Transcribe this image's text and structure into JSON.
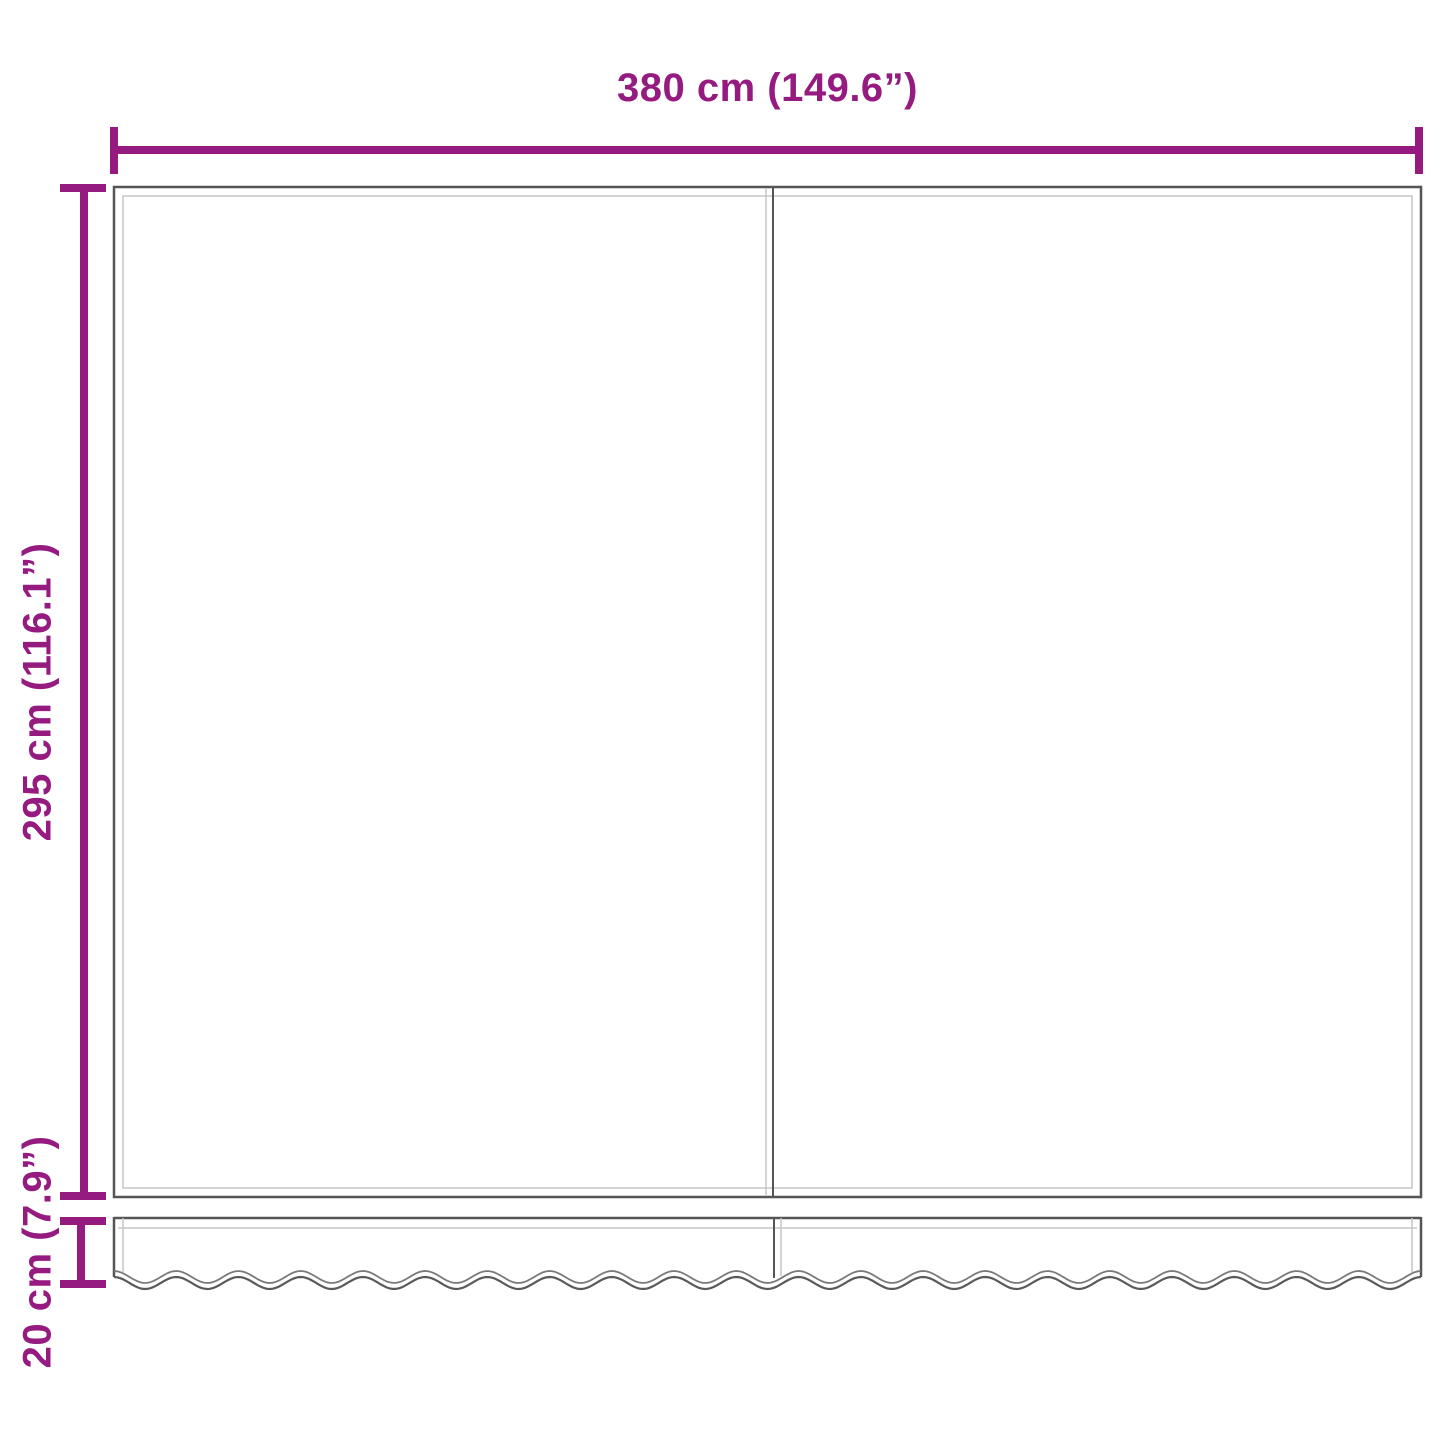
{
  "diagram": {
    "type": "awning-replacement-fabric-dimension-drawing",
    "width_dimension_label": "380 cm (149.6”)",
    "height_dimension_label": "295 cm (116.1”)",
    "valance_height_dimension_label": "20 cm (7.9”)"
  },
  "colors": {
    "accent": "#951b81",
    "line_dark": "#555555",
    "line_light": "#c6c6c6",
    "wave_upper": "#7a7a7a",
    "wave_lower": "#5a5a5a",
    "background": "#ffffff"
  },
  "geometry_notes": {
    "fabric_panels": 2,
    "valance_scallops": 21
  }
}
